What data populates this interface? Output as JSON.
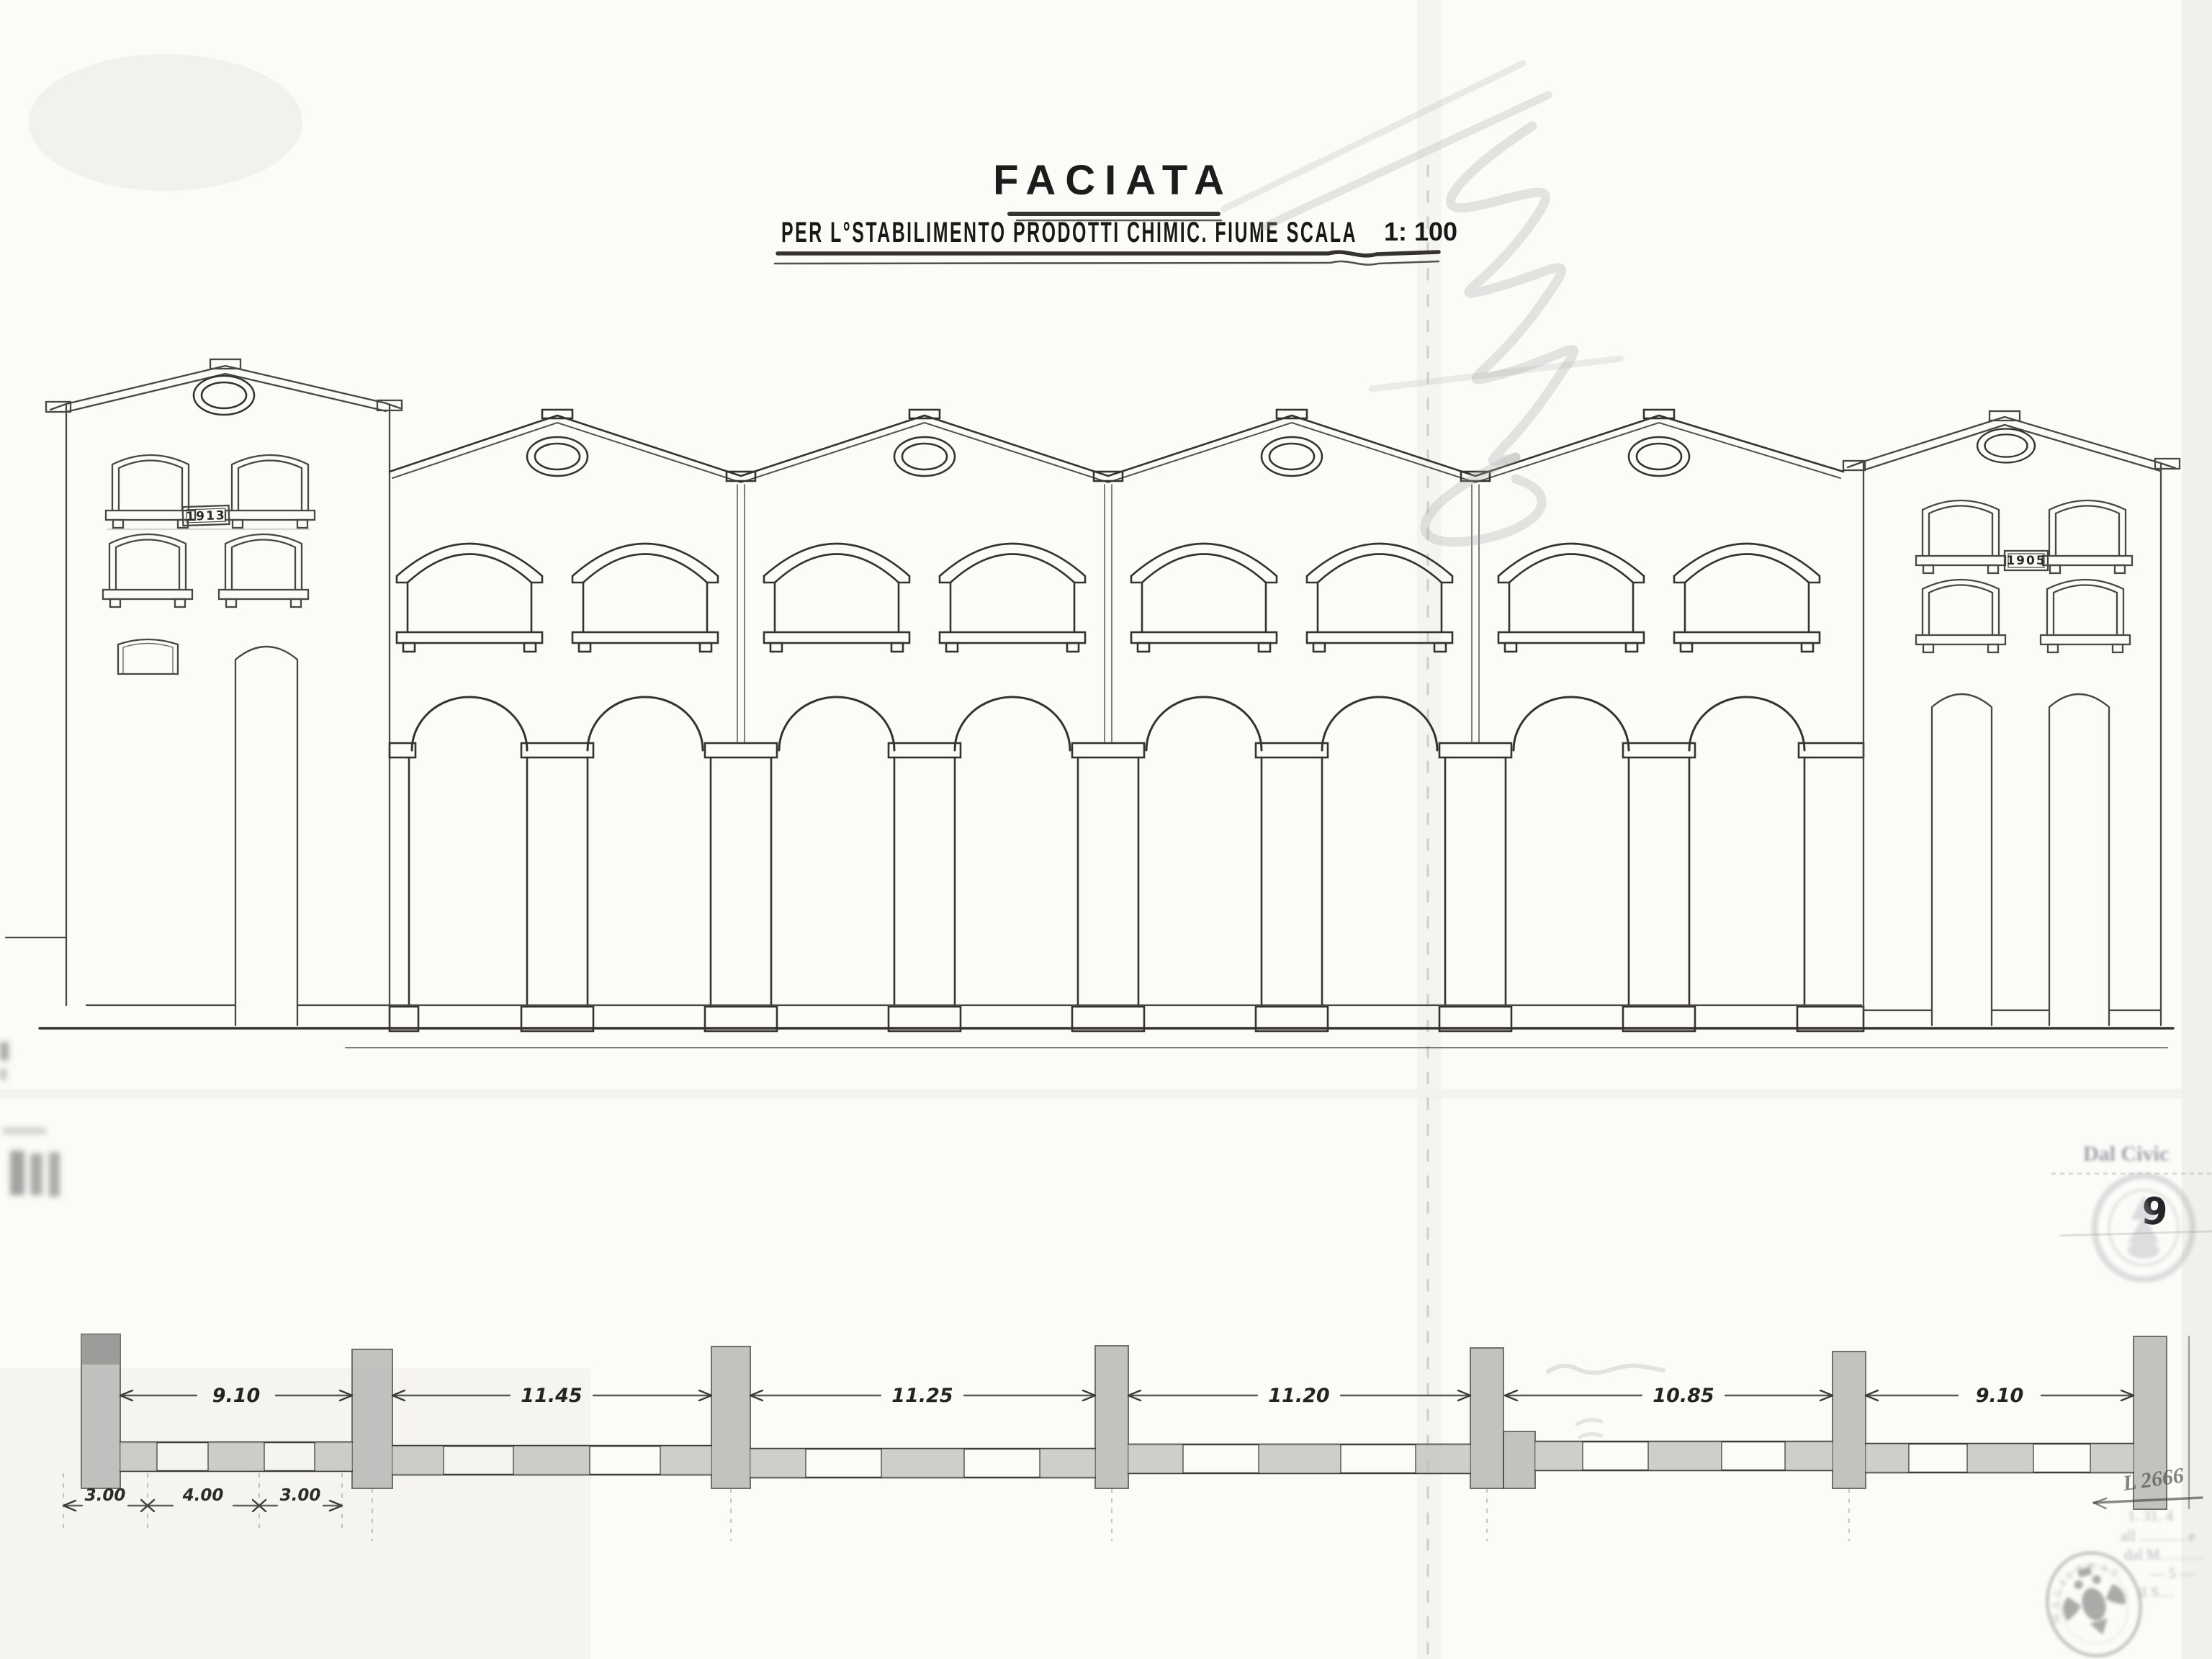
{
  "sheet": {
    "title": "FACIATA",
    "subtitle": "PER L°STABILIMENTO PRODOTTI CHIMIC. FIUME SCALA",
    "scale_value": "1: 100"
  },
  "elevation": {
    "left_building_plaque": "1913",
    "right_building_plaque": "1905"
  },
  "plan": {
    "bay_dimensions": [
      "9.10",
      "11.45",
      "11.25",
      "11.20",
      "10.85",
      "9.10"
    ],
    "left_sub_dimensions": [
      "3.00",
      "4.00",
      "3.00"
    ]
  },
  "annotations": {
    "corner_label": "Dal Civic",
    "handwritten_number": "9",
    "register_mark": "L 2666",
    "stamp_ring_text": "MAGISTRAT",
    "faded_note_lines": [
      "1. 31. 4",
      "all ……… e",
      "dal M………",
      "— 5 —",
      "il S…"
    ]
  },
  "colors": {
    "paper": "#fbfbf8",
    "ink": "#36332e",
    "pencil": "#a9a9a9",
    "stamp_gray": "#7d8288"
  }
}
